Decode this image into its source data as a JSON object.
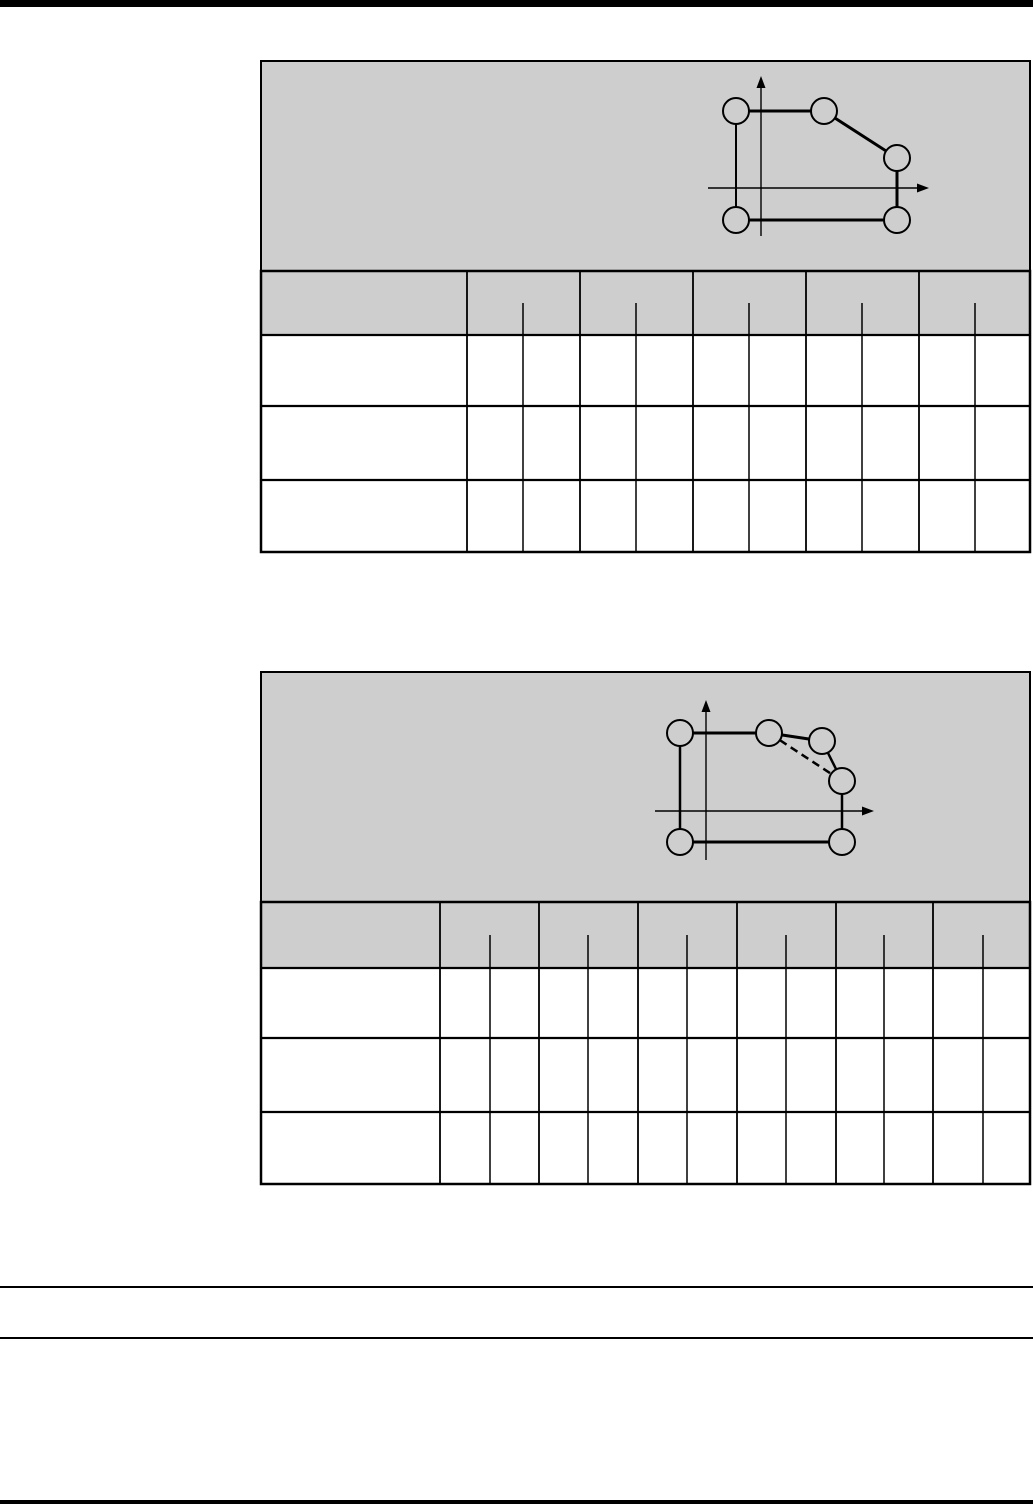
{
  "page": {
    "width": 1033,
    "height": 1506,
    "background_color": "#ffffff",
    "line_color": "#000000",
    "panel_fill_color": "#cecece",
    "visible_text": ""
  },
  "rules": [
    {
      "y": 0,
      "x1": 0,
      "x2": 1033,
      "thickness": 7
    },
    {
      "y": 1286,
      "x1": 0,
      "x2": 1033,
      "thickness": 2
    },
    {
      "y": 1337,
      "x1": 0,
      "x2": 1033,
      "thickness": 2
    },
    {
      "y": 1500,
      "x1": 0,
      "x2": 1033,
      "thickness": 4
    }
  ],
  "figures": [
    {
      "id": "contour-figure-1",
      "box": {
        "x": 261,
        "y": 61,
        "width": 769,
        "height": 210
      },
      "diagram": {
        "y_axis": {
          "x": 761,
          "top": 76,
          "bottom": 236
        },
        "x_axis": {
          "y": 188,
          "left": 708,
          "right": 929
        },
        "point_radius": 13,
        "points": [
          {
            "x": 736,
            "y": 111
          },
          {
            "x": 824,
            "y": 111
          },
          {
            "x": 897,
            "y": 158
          },
          {
            "x": 897,
            "y": 220
          },
          {
            "x": 736,
            "y": 220
          }
        ],
        "edges": [
          {
            "from": 0,
            "to": 1,
            "style": "solid",
            "width": 3
          },
          {
            "from": 1,
            "to": 2,
            "style": "solid",
            "width": 3
          },
          {
            "from": 2,
            "to": 3,
            "style": "solid",
            "width": 3
          },
          {
            "from": 3,
            "to": 4,
            "style": "solid",
            "width": 3
          },
          {
            "from": 4,
            "to": 0,
            "style": "solid",
            "width": 2
          }
        ]
      },
      "table": {
        "left": 261,
        "right": 1030,
        "header_top": 271,
        "header_bottom": 335,
        "row_boundaries": [
          406,
          480
        ],
        "bottom": 552,
        "group_dividers": [
          467,
          580,
          693,
          806,
          919
        ],
        "sub_dividers": [
          523,
          636,
          749,
          862,
          975
        ],
        "label_columns": 1,
        "value_columns": 10,
        "body_rows": 3,
        "cell_text": ""
      }
    },
    {
      "id": "contour-figure-2",
      "box": {
        "x": 261,
        "y": 672,
        "width": 769,
        "height": 230
      },
      "diagram": {
        "y_axis": {
          "x": 706,
          "top": 700,
          "bottom": 860
        },
        "x_axis": {
          "y": 811,
          "left": 655,
          "right": 874
        },
        "point_radius": 13,
        "points": [
          {
            "x": 680,
            "y": 733
          },
          {
            "x": 769,
            "y": 733
          },
          {
            "x": 822,
            "y": 741
          },
          {
            "x": 842,
            "y": 781
          },
          {
            "x": 842,
            "y": 842
          },
          {
            "x": 680,
            "y": 842
          }
        ],
        "edges": [
          {
            "from": 0,
            "to": 1,
            "style": "solid",
            "width": 3
          },
          {
            "from": 1,
            "to": 2,
            "style": "solid",
            "width": 3
          },
          {
            "from": 2,
            "to": 3,
            "style": "solid",
            "width": 2.5
          },
          {
            "from": 3,
            "to": 4,
            "style": "solid",
            "width": 2.5
          },
          {
            "from": 4,
            "to": 5,
            "style": "solid",
            "width": 3
          },
          {
            "from": 5,
            "to": 0,
            "style": "solid",
            "width": 2.5
          },
          {
            "from": 1,
            "to": 3,
            "style": "dashed",
            "width": 2.5
          }
        ]
      },
      "table": {
        "left": 261,
        "right": 1030,
        "header_top": 902,
        "header_bottom": 968,
        "row_boundaries": [
          1038,
          1112
        ],
        "bottom": 1184,
        "group_dividers": [
          440,
          539,
          638,
          737,
          836,
          933
        ],
        "sub_dividers": [
          490,
          588,
          687,
          786,
          884,
          983
        ],
        "label_columns": 1,
        "value_columns": 12,
        "body_rows": 3,
        "cell_text": ""
      }
    }
  ]
}
